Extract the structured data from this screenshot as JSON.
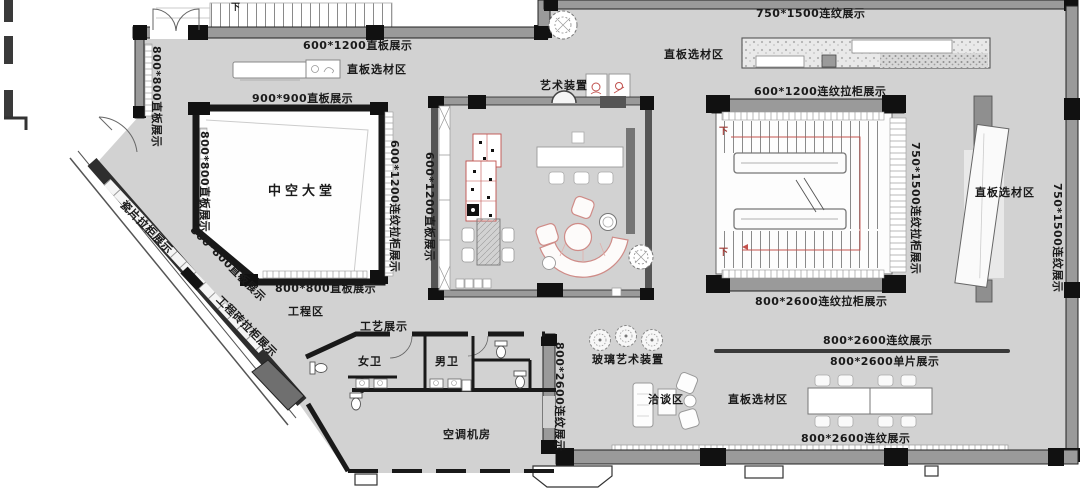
{
  "plan": {
    "title": "showroom floor plan",
    "colors": {
      "floor": "#d2d2d2",
      "wall_gray": "#9a9a9a",
      "wall_dark": "#141414",
      "accent_red": "#c0504d",
      "text": "#1a1a1a"
    },
    "labels": {
      "display_600x1200_flat_top": "600*1200直板展示",
      "select_area_top_left": "直板选材区",
      "display_900x900_flat": "900*900直板展示",
      "atrium": "中空大堂",
      "art_installation": "艺术装置",
      "display_750x1500_pattern_top": "750*1500连纹展示",
      "select_area_top_right": "直板选材区",
      "display_600x1200_pattern_cabinet_top": "600*1200连纹拉柜展示",
      "display_800x2600_pattern_cabinet": "800*2600连纹拉柜展示",
      "display_800x2600_pattern_mid": "800*2600连纹展示",
      "display_800x2600_single": "800*2600单片展示",
      "select_area_bottom": "直板选材区",
      "display_800x2600_pattern_bottom": "800*2600连纹展示",
      "talk_area": "洽谈区",
      "glass_art": "玻璃艺术装置",
      "engineering_area": "工程区",
      "craft_display": "工艺展示",
      "women_wc": "女卫",
      "men_wc": "男卫",
      "hvac_room": "空调机房",
      "display_800x800_flat_bottom": "800*800直板展示",
      "select_area_right": "直板选材区",
      "stair_down_top": "下",
      "stair_down_inner_1": "下",
      "stair_down_inner_2": "下",
      "v_display_800x800_flat_1": "800*800直板展示",
      "v_display_800x800_flat_2": "800*800直板展示",
      "v_display_600x1200_pattern_cabinet": "600*1200连纹拉柜展示",
      "v_display_600x1200_flat": "600*1200直板展示",
      "v_display_750x1500_pattern_cabinet": "750*1500连纹拉柜展示",
      "v_display_750x1500_pattern": "750*1500连纹展示",
      "v_display_800x2600_pattern": "800*2600连纹展示",
      "d_display_tile_cabinet": "瓷片拉柜展示",
      "d_display_800x800_flat": "800*800直板展示",
      "d_display_eng_brick_cabinet": "工程砖拉柜展示"
    }
  }
}
